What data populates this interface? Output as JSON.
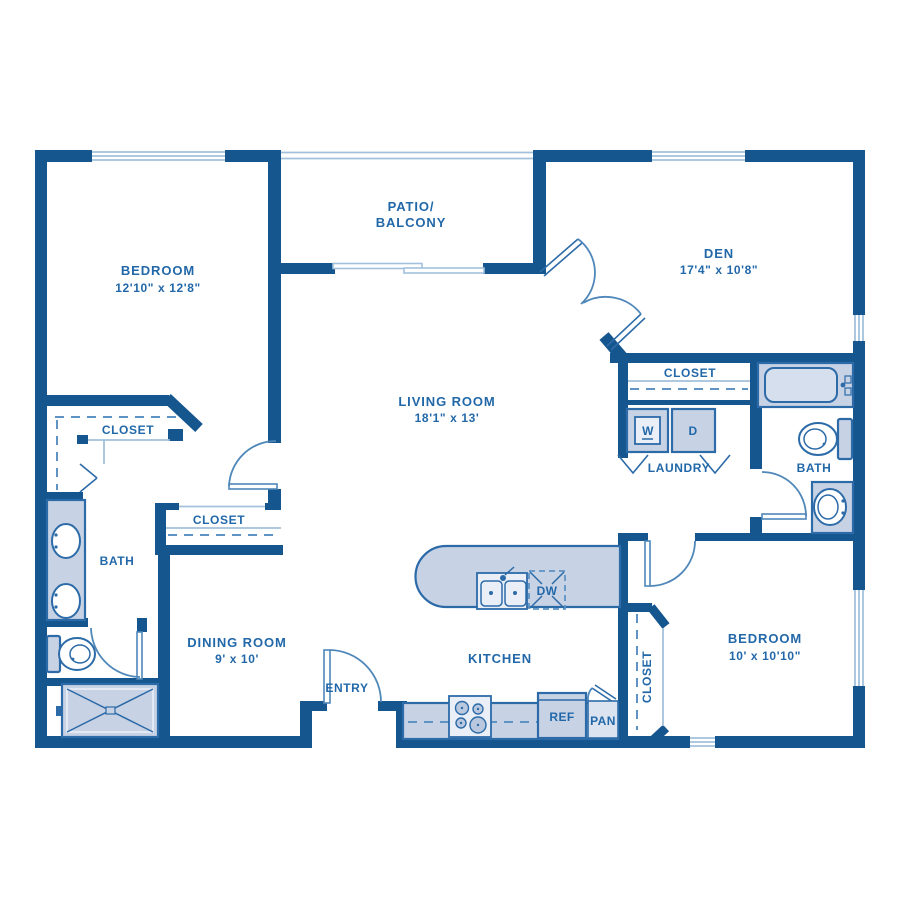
{
  "plan": {
    "colors": {
      "background": "#ffffff",
      "wall": "#16568f",
      "label_text": "#2268a9",
      "fixture_fill": "#c8d2e5",
      "fixture_fill_light": "#e9eef7",
      "fixture_stroke": "#2c6ba8",
      "thin_line": "#a3c1dc",
      "dash_line": "#5e93c4",
      "door_arc": "#4f87b9"
    },
    "rooms": {
      "bedroom1": {
        "label": "BEDROOM",
        "dims": "12'10\" x 12'8\""
      },
      "patio": {
        "label_line1": "PATIO/",
        "label_line2": "BALCONY"
      },
      "den": {
        "label": "DEN",
        "dims": "17'4\" x 10'8\""
      },
      "living_room": {
        "label": "LIVING ROOM",
        "dims": "18'1\" x 13'"
      },
      "dining_room": {
        "label": "DINING ROOM",
        "dims": "9' x 10'"
      },
      "kitchen": {
        "label": "KITCHEN"
      },
      "entry": {
        "label": "ENTRY"
      },
      "laundry": {
        "label": "LAUNDRY"
      },
      "bath_left": {
        "label": "BATH"
      },
      "bath_right": {
        "label": "BATH"
      },
      "bedroom2": {
        "label": "BEDROOM",
        "dims": "10' x 10'10\""
      },
      "closet_bedroom1": {
        "label": "CLOSET"
      },
      "closet_hall": {
        "label": "CLOSET"
      },
      "closet_laundry": {
        "label": "CLOSET"
      },
      "closet_bedroom2": {
        "label": "CLOSET"
      }
    },
    "appliances": {
      "washer": "W",
      "dryer": "D",
      "dishwasher": "DW",
      "refrigerator": "REF",
      "pantry": "PAN"
    }
  }
}
